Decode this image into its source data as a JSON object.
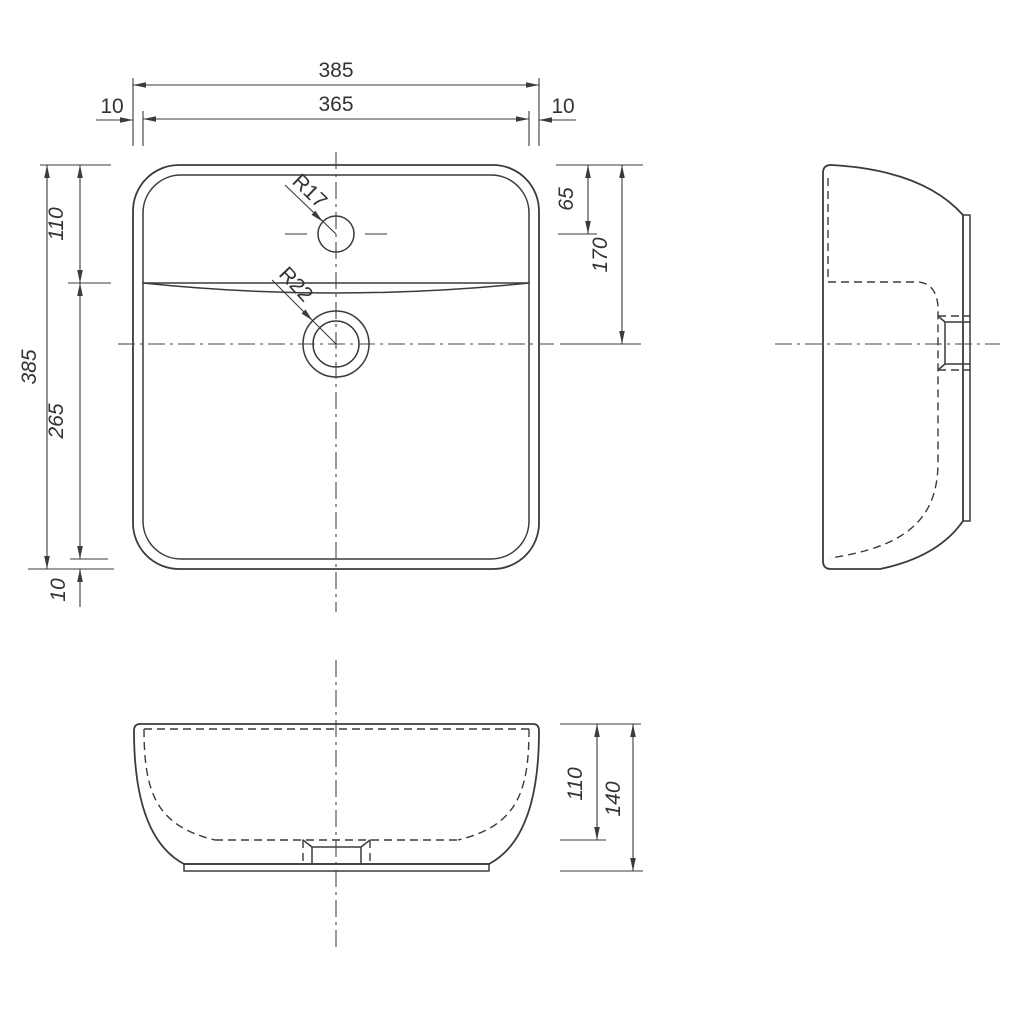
{
  "drawing": {
    "type": "technical-drawing",
    "subject": "countertop-washbasin-three-views",
    "colors": {
      "line": "#3b3b3b",
      "text": "#333333",
      "background": "#ffffff"
    }
  },
  "dims": {
    "plan_overall_width": "385",
    "plan_inner_width": "365",
    "plan_margin_left": "10",
    "plan_margin_right": "10",
    "plan_overall_height": "385",
    "plan_top_to_overflow": "110",
    "plan_overflow_to_inner_bottom": "265",
    "plan_margin_bottom": "10",
    "faucet_from_top": "65",
    "drain_from_top": "170",
    "faucet_hole_radius": "R17",
    "drain_hole_radius": "R22",
    "front_rim_to_bottom_inside": "110",
    "front_overall_height": "140"
  }
}
